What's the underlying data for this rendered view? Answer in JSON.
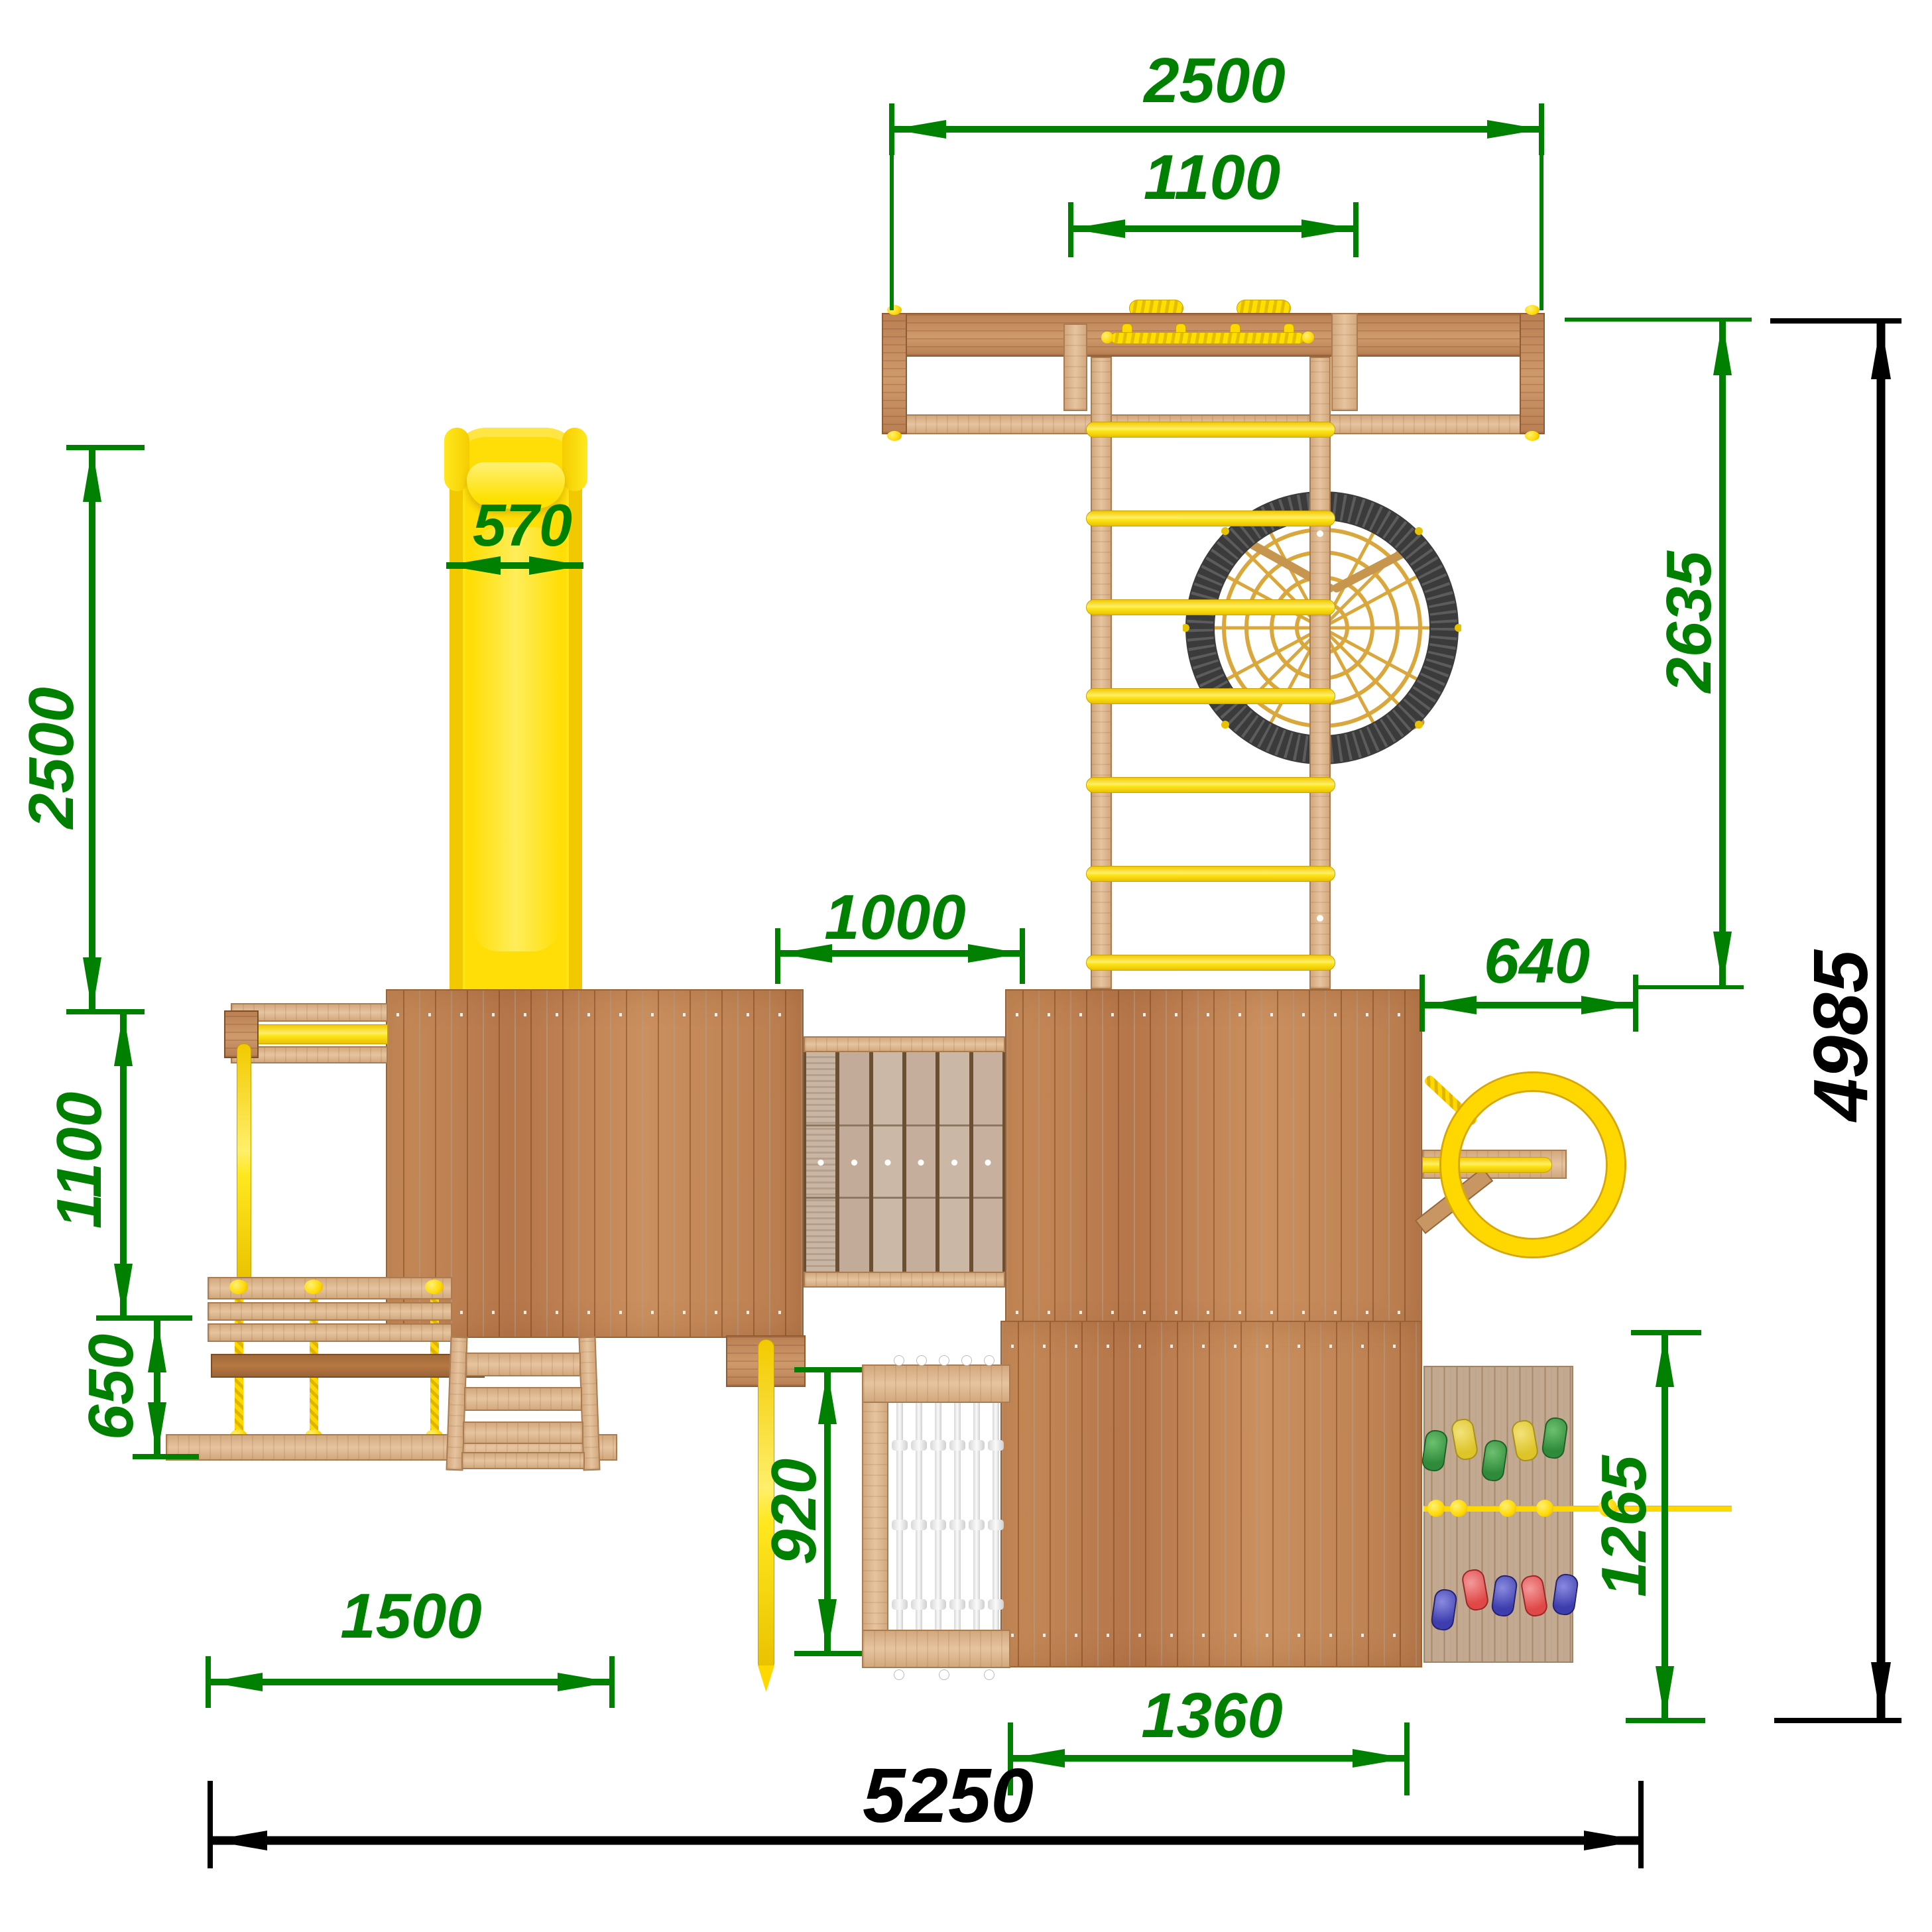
{
  "drawing": {
    "title": "Playground set — top view dimensional drawing",
    "units": "mm",
    "dimensions": {
      "top_beam_width": "2500",
      "top_beam_inner": "1100",
      "slide_width": "570",
      "slide_length": "2500",
      "swing_bay_depth": "1100",
      "rope_ladder_drop": "650",
      "bridge_width": "1000",
      "ladder_reach": "2635",
      "side_offset": "640",
      "net_drop": "920",
      "stairs_span": "1500",
      "climb_wall_drop": "1265",
      "lower_tower_width": "1360",
      "total_width": "5250",
      "total_depth": "4985"
    },
    "colors": {
      "dimension_green": "#008000",
      "dimension_black": "#000000",
      "wood_light": "#d9ab83",
      "wood_plywood": "#bf8153",
      "accent_yellow": "#ffdf00",
      "nest_ring": "#3b3b3b",
      "net_rope": "#ededed"
    }
  }
}
